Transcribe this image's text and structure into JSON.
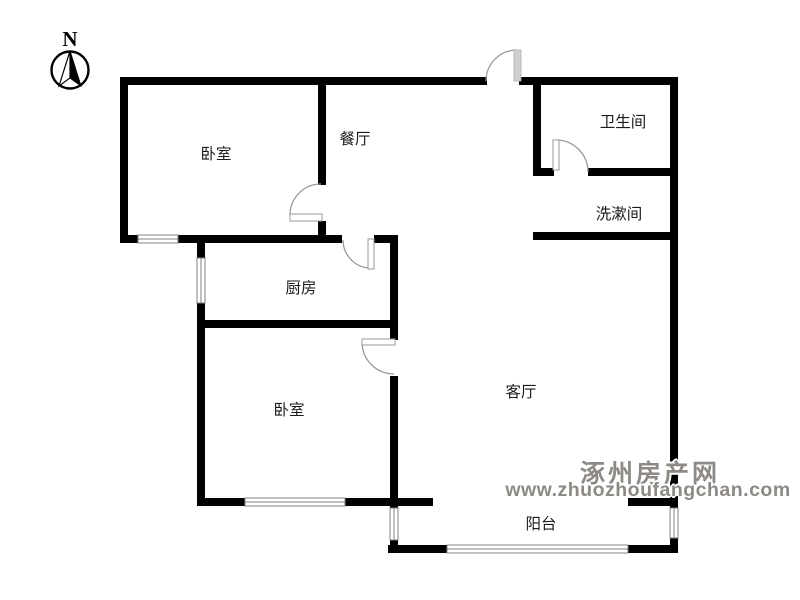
{
  "floor_plan": {
    "compass": {
      "label": "N"
    },
    "rooms": [
      {
        "id": "bedroom-1",
        "label": "卧室"
      },
      {
        "id": "dining-room",
        "label": "餐厅"
      },
      {
        "id": "bathroom",
        "label": "卫生间"
      },
      {
        "id": "washroom",
        "label": "洗漱间"
      },
      {
        "id": "kitchen",
        "label": "厨房"
      },
      {
        "id": "bedroom-2",
        "label": "卧室"
      },
      {
        "id": "living-room",
        "label": "客厅"
      },
      {
        "id": "balcony",
        "label": "阳台"
      }
    ],
    "watermark": {
      "site_name": "涿州房产网",
      "site_url": "www.zhuozhoufangchan.com"
    },
    "colors": {
      "background": "#ffffff",
      "wall": "#000000",
      "door": "#9a9a9a",
      "window_line": "#808080",
      "label_text": "#1a1a1a",
      "watermark_text": "#8d8984"
    }
  }
}
